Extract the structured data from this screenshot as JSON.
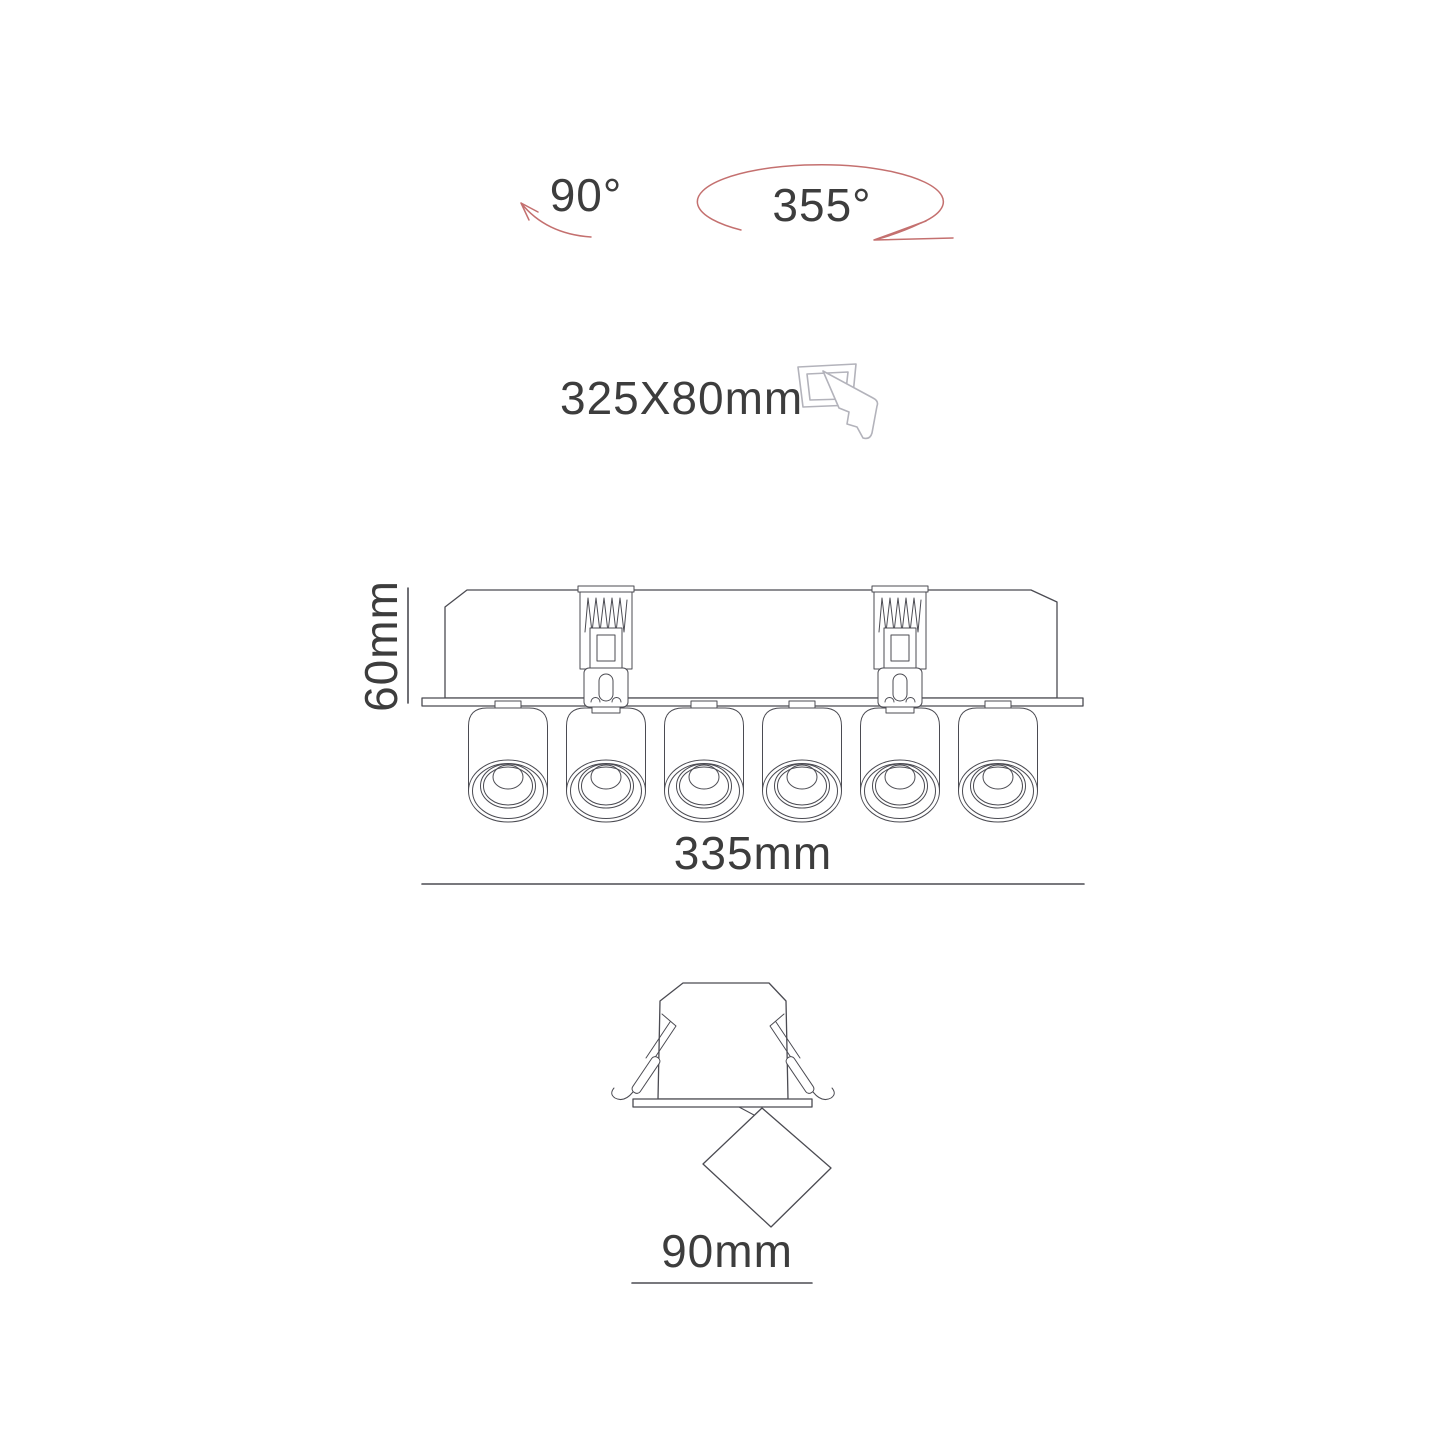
{
  "colors": {
    "line": "#4b4b52",
    "text": "#3d3d3d",
    "red": "#c4706f",
    "icon": "#b3b3bb"
  },
  "labels": {
    "tilt_angle": "90°",
    "rotation_angle": "355°",
    "cutout_size": "325X80mm",
    "fixture_height": "60mm",
    "fixture_length": "335mm",
    "head_width": "90mm"
  }
}
